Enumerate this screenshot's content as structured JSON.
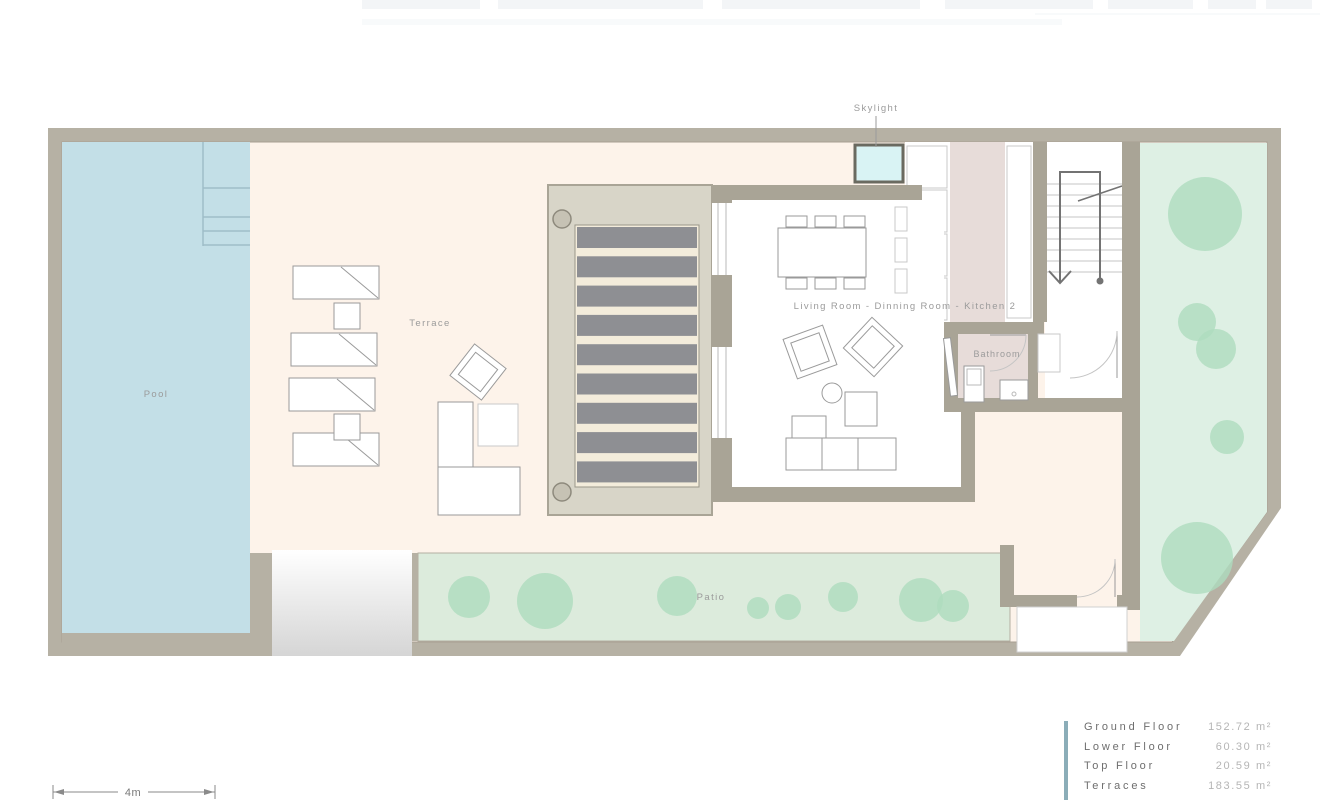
{
  "labels": {
    "skylight": "Skylight",
    "pool": "Pool",
    "terrace": "Terrace",
    "living": "Living Room - Dinning Room - Kitchen 2",
    "bathroom": "Bathroom",
    "patio": "Patio"
  },
  "legend": {
    "accent_color": "#8badb8",
    "rows": [
      {
        "label": "Ground Floor",
        "value": "152.72 m²"
      },
      {
        "label": "Lower Floor",
        "value": "60.30 m²"
      },
      {
        "label": "Top Floor",
        "value": "20.59 m²"
      },
      {
        "label": "Terraces",
        "value": "183.55 m²"
      }
    ]
  },
  "scale_bar": {
    "label": "4m"
  },
  "plan": {
    "colors": {
      "wall": "#b6b1a4",
      "house_wall": "#a9a496",
      "terrace": "#fdf3ea",
      "pool": "#c3dfe7",
      "pool_line": "#9fbdc8",
      "skylight": "#d9f3f4",
      "pergola_bg": "#d8d5c8",
      "pergola_gap": "#f3ecdb",
      "slat": "#8e8f93",
      "column": "#c6c2b4",
      "kitchen_pink": "#e7dcd9",
      "patio_bg": "#dcebdc",
      "garden_bg": "#def0e4",
      "tree": "#aedcbe",
      "furniture_stroke": "#9a9a9a",
      "label": "#9b9b9b",
      "stair_line": "#c6c6c6",
      "railing": "#737373"
    },
    "pergola": {
      "slat_count": 9
    },
    "stairs": {
      "tread_count": 9
    },
    "patio_trees": [
      [
        469,
        597,
        21
      ],
      [
        545,
        601,
        28
      ],
      [
        677,
        596,
        20
      ],
      [
        758,
        608,
        11
      ],
      [
        788,
        607,
        13
      ],
      [
        843,
        597,
        15
      ],
      [
        921,
        600,
        22
      ],
      [
        953,
        606,
        16
      ]
    ],
    "garden_trees": [
      [
        1205,
        214,
        37
      ],
      [
        1197,
        322,
        19
      ],
      [
        1216,
        349,
        20
      ],
      [
        1227,
        437,
        17
      ],
      [
        1197,
        558,
        36
      ]
    ],
    "loungers": [
      [
        293,
        266
      ],
      [
        291,
        333
      ],
      [
        289,
        378
      ],
      [
        293,
        433
      ]
    ],
    "lounger_tables": [
      [
        334,
        303
      ],
      [
        334,
        414
      ]
    ],
    "dining_chairs": [
      [
        786,
        216
      ],
      [
        815,
        216
      ],
      [
        844,
        216
      ],
      [
        786,
        278
      ],
      [
        815,
        278
      ],
      [
        844,
        278
      ]
    ]
  }
}
